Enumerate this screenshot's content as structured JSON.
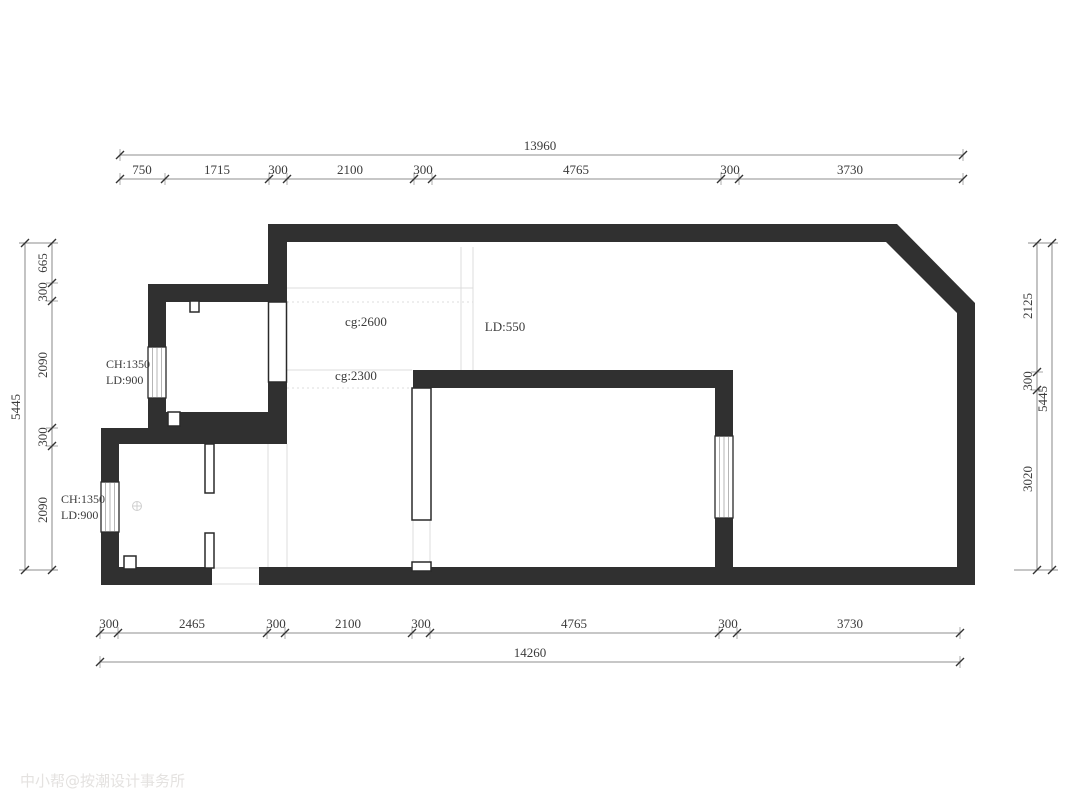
{
  "drawing": {
    "type": "floor-plan",
    "watermark": "中小帮@按潮设计事务所"
  },
  "colors": {
    "wall_fill": "#303030",
    "dim_line": "#6a6a6a",
    "tick": "#333333",
    "text": "#3b3b3b",
    "faint_line": "#dcdcdc",
    "window_hatch": "#b5b5b5",
    "watermark": "#e4e2e0"
  },
  "dims": {
    "top_total": "13960",
    "top_segments": [
      "750",
      "1715",
      "300",
      "2100",
      "300",
      "4765",
      "300",
      "3730"
    ],
    "bottom_segments": [
      "300",
      "2465",
      "300",
      "2100",
      "300",
      "4765",
      "300",
      "3730"
    ],
    "bottom_total": "14260",
    "left_total": "5445",
    "left_segments": [
      "665",
      "300",
      "2090",
      "300",
      "2090"
    ],
    "right_segments": [
      "2125",
      "300",
      "3020"
    ],
    "right_total": "5445"
  },
  "labels": {
    "ceiling_living": "cg:2600",
    "ceiling_hall": "cg:2300",
    "lowered_550": "LD:550",
    "window_upper_ch": "CH:1350",
    "window_upper_ld": "LD:900",
    "window_lower_ch": "CH:1350",
    "window_lower_ld": "LD:900"
  }
}
